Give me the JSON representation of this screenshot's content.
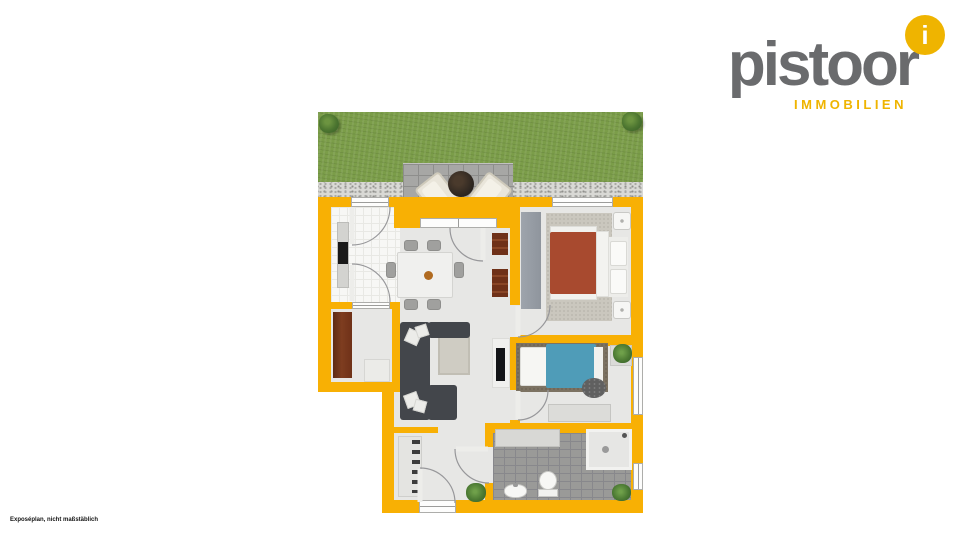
{
  "logo": {
    "word": "pistoor",
    "subtitle": "IMMOBILIEN",
    "badge_letter": "i"
  },
  "footer": {
    "disclaimer": "Exposéplan, nicht maßstäblich"
  },
  "colors": {
    "wall": "#F8B004",
    "logo-gray": "#6A6B6D",
    "logo-yellow": "#EFB400",
    "floor": "#E7E7E5",
    "bed1-blanket": "#A84A2F",
    "bed2-blanket": "#4F9CB8",
    "sofa": "#43464B",
    "wood": "#6F3118"
  }
}
